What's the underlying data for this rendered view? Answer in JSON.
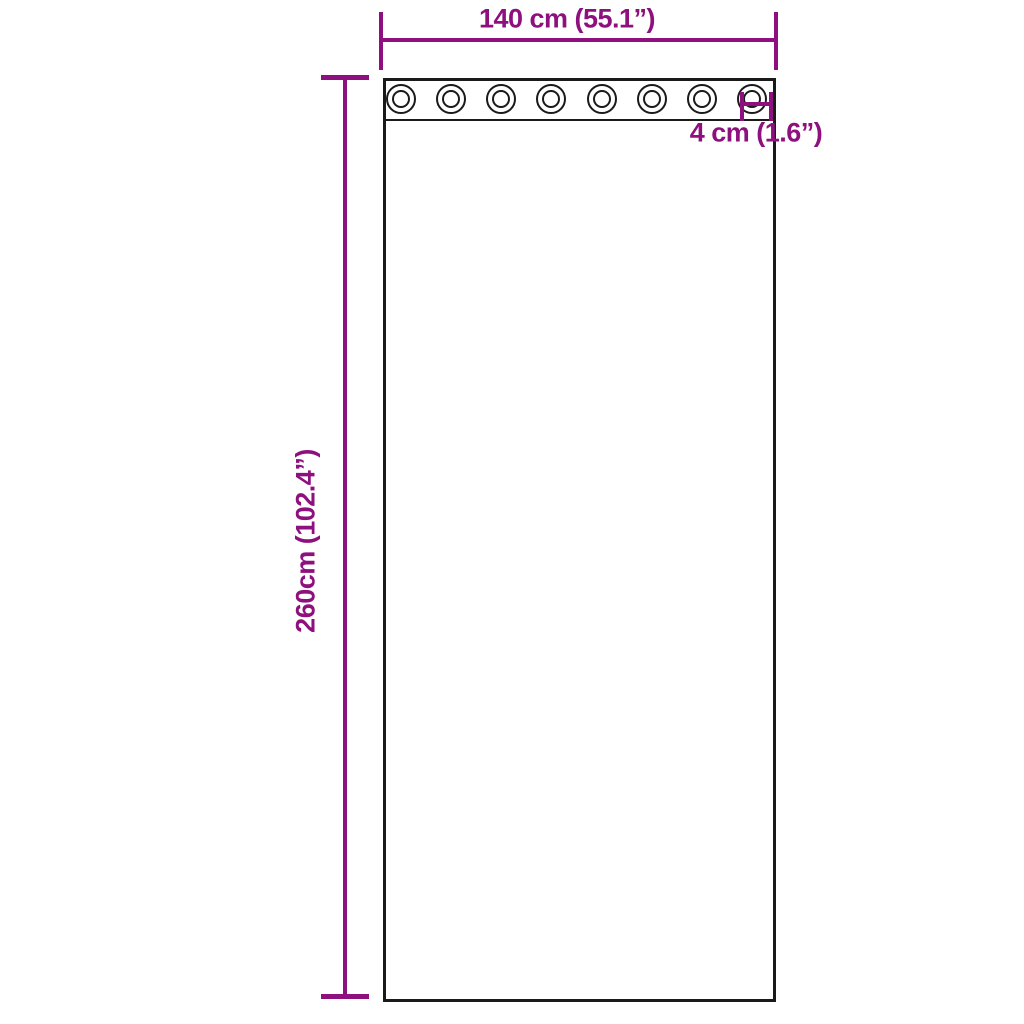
{
  "diagram": {
    "type": "product-dimension-diagram",
    "subject": "curtain panel with grommets",
    "colors": {
      "dimension_purple": "#8E107E",
      "outline_black": "#1a1a1a",
      "background": "#ffffff"
    },
    "dimensions": {
      "width_label": "140 cm (55.1”)",
      "height_label": "260cm (102.4”)",
      "grommet_label": "4 cm (1.6”)"
    },
    "curtain": {
      "grommet_count": 8
    }
  }
}
